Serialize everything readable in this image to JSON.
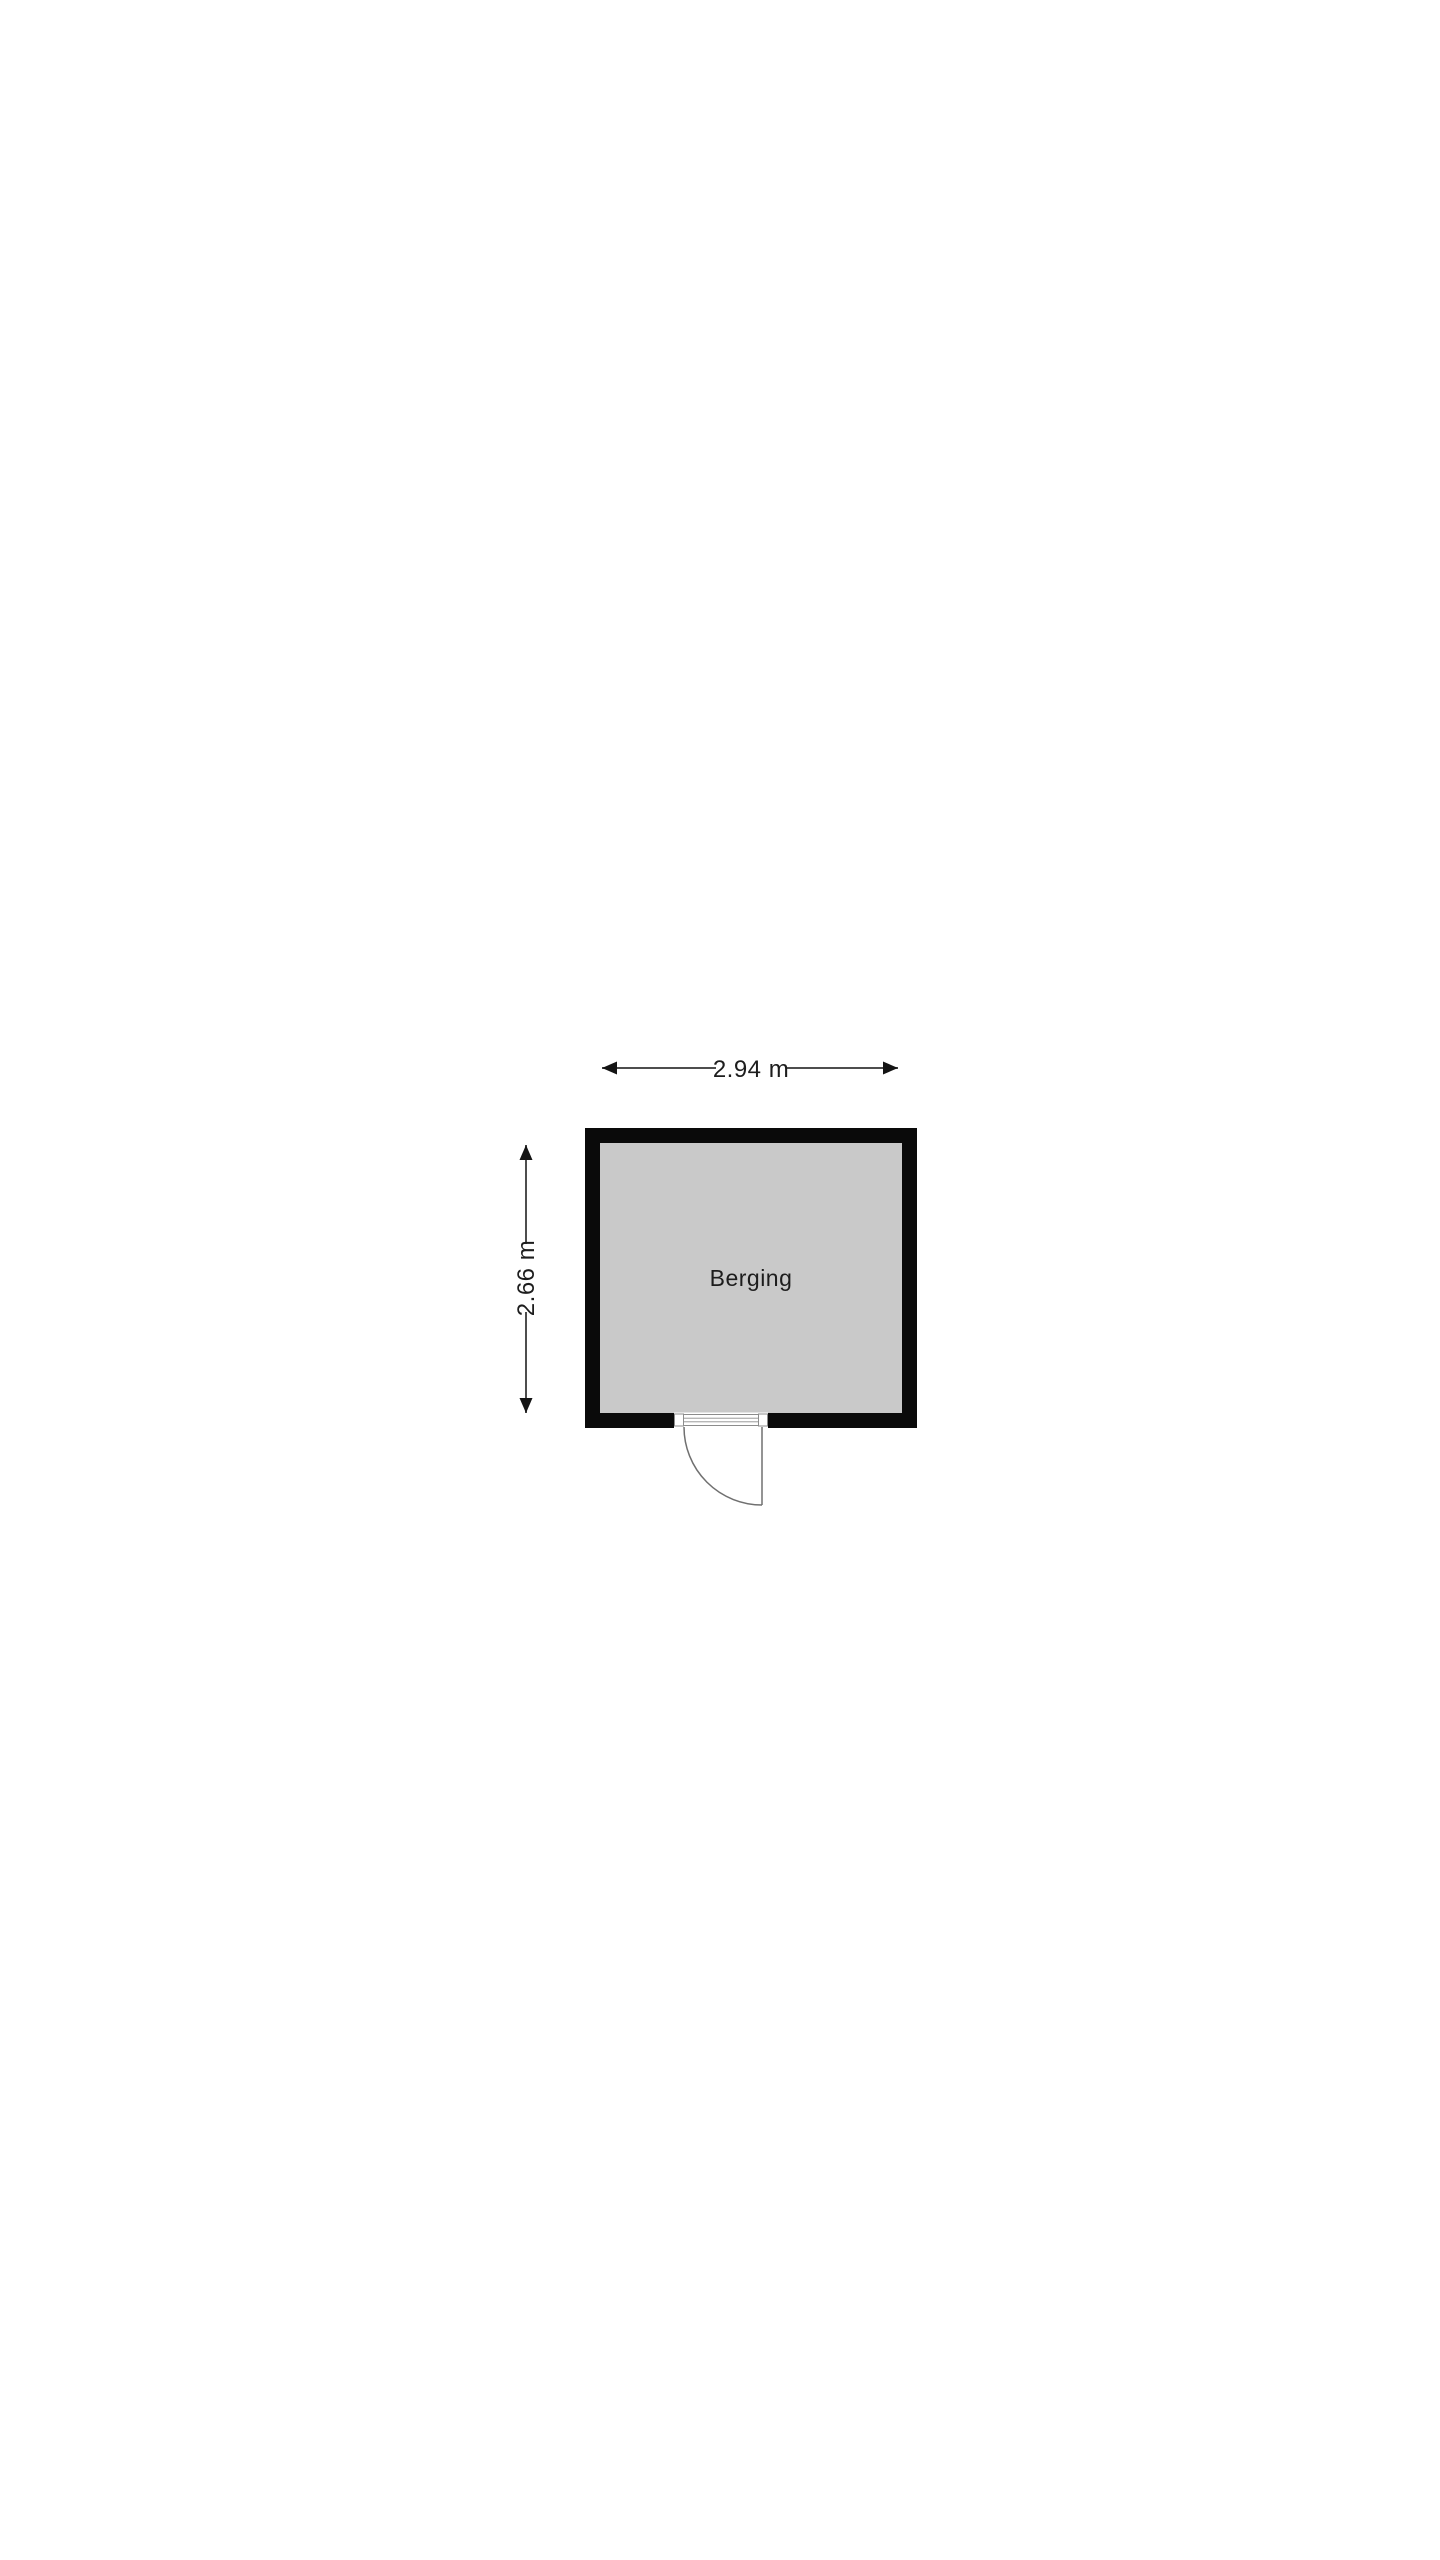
{
  "floor_plan": {
    "room": {
      "label": "Berging"
    },
    "dimensions": {
      "width_label": "2.94 m",
      "height_label": "2.66 m"
    },
    "colors": {
      "background": "#ffffff",
      "wall": "#0a0a0a",
      "floor": "#c9c9c9",
      "dimension_line": "#4d4d4d",
      "arrowhead": "#141414",
      "label_text": "#1d1d1d",
      "door_line": "#707070",
      "door_frame": "#8c8c8c",
      "door_fill": "#ffffff"
    }
  }
}
